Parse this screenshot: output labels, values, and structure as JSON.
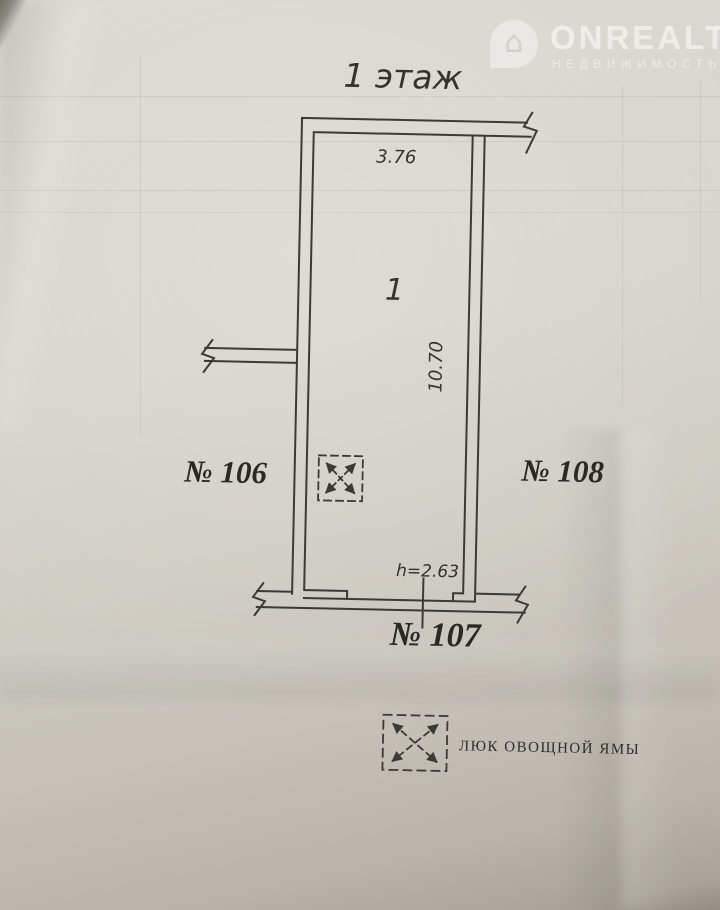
{
  "watermark": {
    "brand": "ONREALT",
    "subtitle": "НЕДВИЖИМОСТЬ",
    "icon": "house-pin-icon",
    "color": "#ffffff"
  },
  "plan": {
    "title": "1 этаж",
    "room_number": "1",
    "dimensions": {
      "top_width_m": "3.76",
      "side_length_m": "10.70",
      "ceiling_height": "h=2.63"
    },
    "adjacent_units": {
      "left": "№ 106",
      "right": "№ 108",
      "bottom": "№ 107"
    },
    "legend": {
      "symbol": "vegetable-pit-hatch",
      "label": "люк овощной ямы"
    },
    "line_color": "#3c3a34",
    "paper_color": "#d6d3cc"
  }
}
